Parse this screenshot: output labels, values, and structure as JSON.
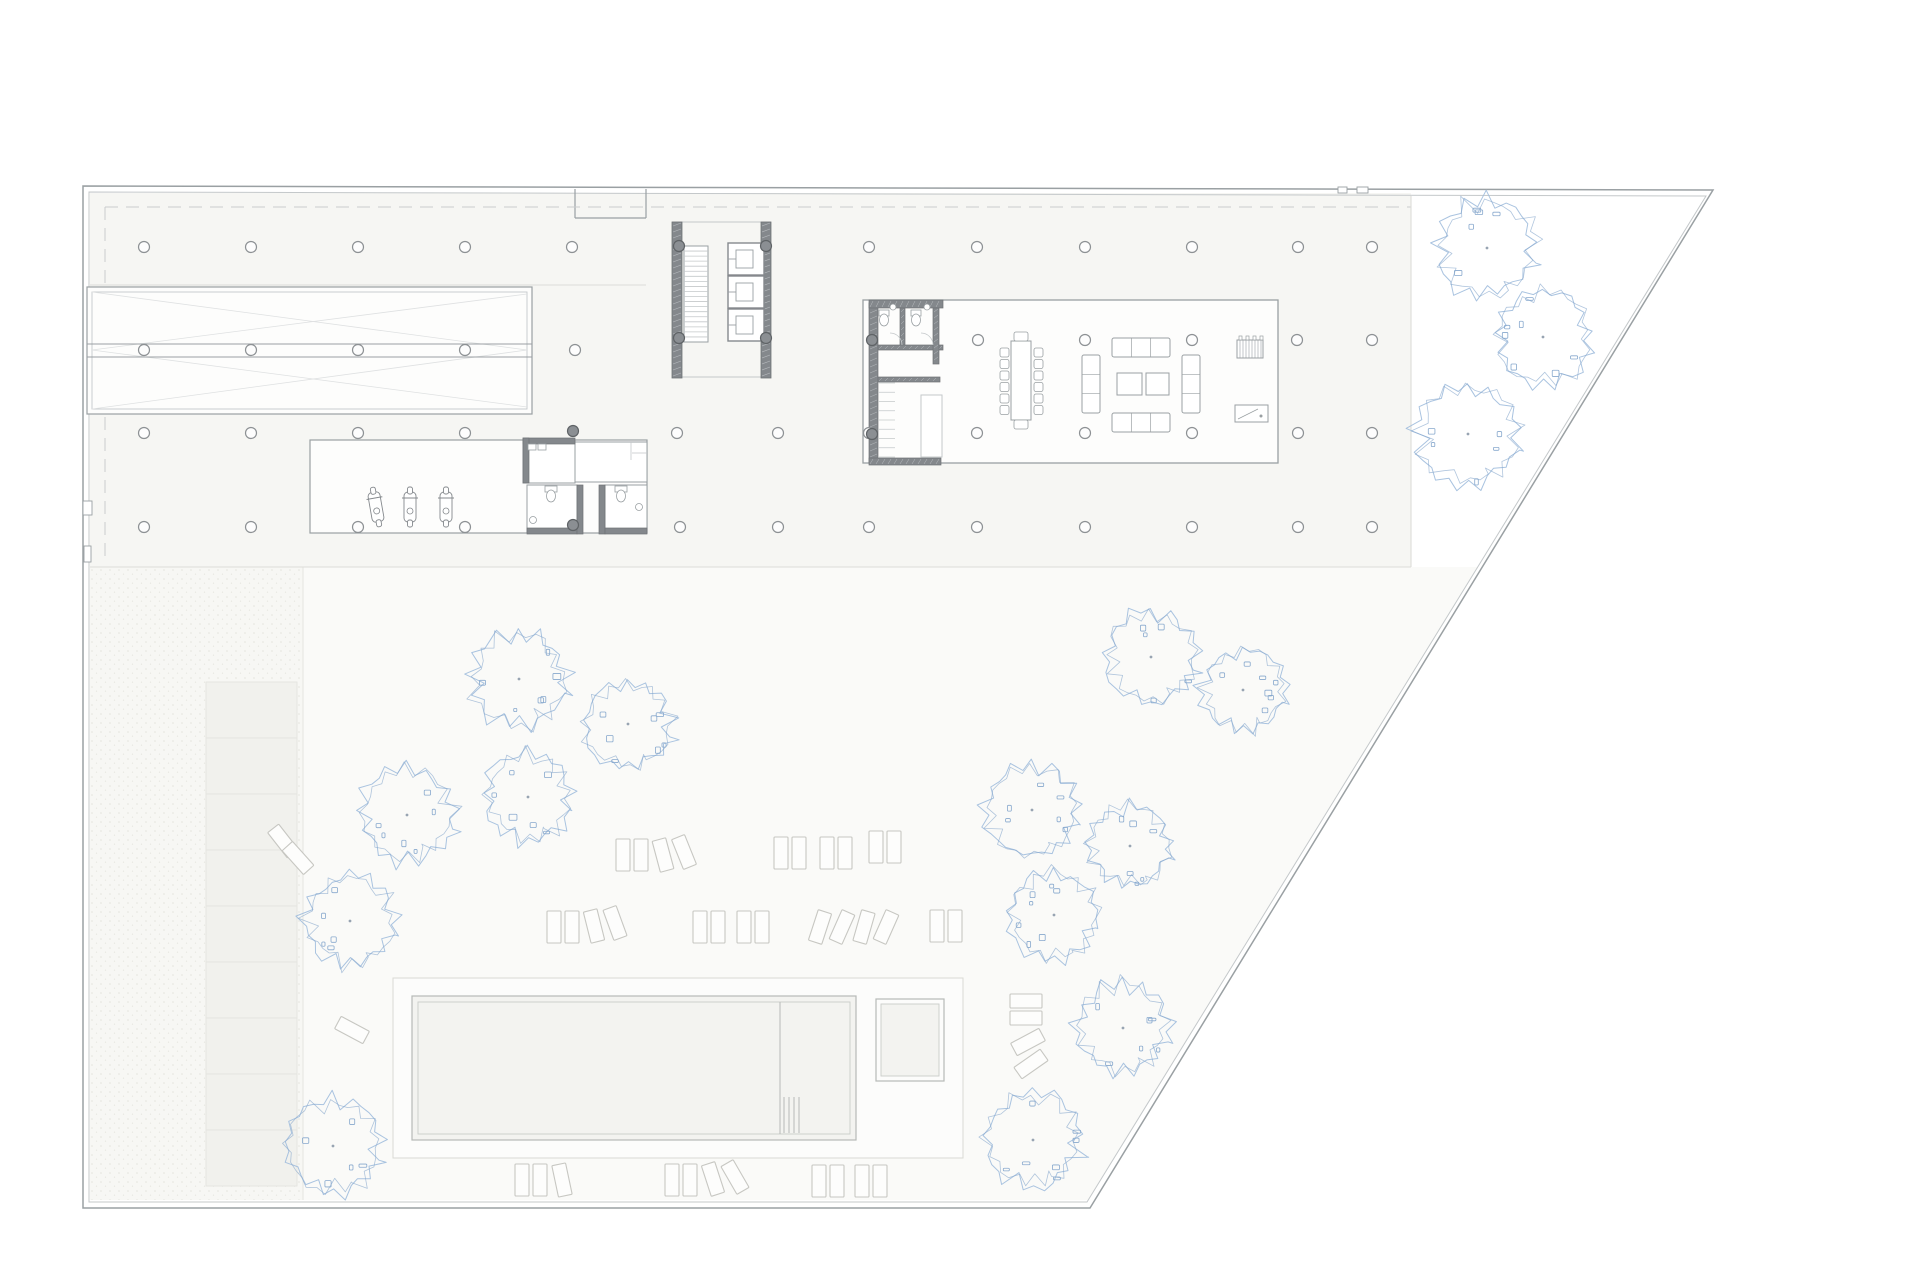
{
  "meta": {
    "title": "architectural-site-plan",
    "description": "Ground floor site plan: trapezoidal plot with building band (parking ramp, stair and elevator core, lounge room, garage, restrooms), pool terrace, loungers and trees"
  },
  "canvas": {
    "w": 1920,
    "h": 1280,
    "bg": "#ffffff"
  },
  "palette": {
    "line": "#9aa0a3",
    "line_light": "#c4c8ca",
    "line_faint": "#dcdcd8",
    "wall_dark": "#84888c",
    "wall_edge": "#6f7376",
    "plate_fill": "#f6f6f3",
    "landscape_fill": "#fafaf8",
    "stipple_fill": "#f7f7f4",
    "parking_fill": "#f1f1ed",
    "parking_line": "#e4e4df",
    "room_fill": "#fdfdfc",
    "pool_fill": "#f3f3f0",
    "deck_fill": "#fcfcfb",
    "deck_line": "#d9d9d5",
    "dash_line": "#c9ccce",
    "tree_stroke": "#a0bddd",
    "tree_accent": "#87a8cd",
    "tree_dot": "#98a4b2",
    "furniture": "#9aa0a3",
    "lounger_line": "#c7c7c2",
    "lounger_fill": "#fdfdfc"
  },
  "site": {
    "outer": [
      [
        83,
        186
      ],
      [
        1713,
        190
      ],
      [
        1090,
        1208
      ],
      [
        83,
        1208
      ]
    ],
    "inner": [
      [
        89,
        192
      ],
      [
        1706,
        196
      ],
      [
        1087,
        1202
      ],
      [
        89,
        1202
      ]
    ],
    "notch": {
      "x1": 575,
      "x2": 646,
      "y_top": 189,
      "y_bottom": 218
    },
    "top_ticks": [
      [
        1338,
        187,
        9,
        6
      ],
      [
        1357,
        187,
        11,
        6
      ]
    ],
    "left_marks": [
      [
        83,
        501,
        9,
        14
      ],
      [
        84,
        546,
        7,
        16
      ]
    ]
  },
  "zones": {
    "plate": {
      "x": 90,
      "y": 193,
      "w": 1321,
      "h": 374
    },
    "landscape": [
      [
        90,
        567
      ],
      [
        1478,
        567
      ],
      [
        1088,
        1200
      ],
      [
        90,
        1200
      ]
    ],
    "stipple": {
      "x": 90,
      "y": 567,
      "w": 213,
      "h": 633
    },
    "divider_x": 303,
    "plate_lines": [
      [
        90,
        285,
        646,
        285
      ],
      [
        90,
        567,
        1411,
        567
      ],
      [
        1411,
        196,
        1411,
        567
      ]
    ]
  },
  "dashed_lines": [
    [
      105,
      207,
      1411,
      207
    ],
    [
      105,
      207,
      105,
      563
    ]
  ],
  "ramp": {
    "outer": {
      "x": 87,
      "y": 287,
      "w": 445,
      "h": 127
    },
    "inset": 5,
    "center_y1": 344,
    "center_y2": 357,
    "diagonals": [
      [
        92,
        292,
        527,
        350
      ],
      [
        92,
        409,
        527,
        350
      ],
      [
        92,
        350,
        527,
        294
      ],
      [
        92,
        350,
        527,
        407
      ]
    ]
  },
  "core": {
    "wall_left": {
      "x": 672,
      "y": 222,
      "w": 10,
      "h": 156
    },
    "wall_right": {
      "x": 761,
      "y": 222,
      "w": 10,
      "h": 156
    },
    "top_line": [
      672,
      222,
      771,
      222
    ],
    "bottom_line": [
      672,
      377,
      771,
      377
    ],
    "stair": {
      "x": 684,
      "y": 246,
      "w": 24,
      "h": 96,
      "treads": 19
    },
    "elevators": {
      "x": 728,
      "w": 36,
      "h": 32,
      "ys": [
        243,
        276,
        309
      ]
    }
  },
  "lounge_room": {
    "rect": {
      "x": 863,
      "y": 300,
      "w": 415,
      "h": 163
    },
    "walls": [
      [
        869,
        303,
        9,
        160
      ],
      [
        869,
        300,
        74,
        8
      ],
      [
        900,
        308,
        5,
        39
      ],
      [
        878,
        345,
        65,
        5
      ],
      [
        933,
        308,
        6,
        56
      ],
      [
        878,
        377,
        62,
        5
      ],
      [
        869,
        458,
        72,
        7
      ]
    ],
    "shaft": {
      "x": 921,
      "y": 395,
      "w": 21,
      "h": 62
    },
    "stair": {
      "x": 878,
      "y": 383,
      "w": 17,
      "h": 74,
      "treads": 9
    },
    "toilets": [
      [
        884,
        318
      ],
      [
        916,
        318
      ]
    ],
    "sinks": [
      [
        893,
        307
      ],
      [
        927,
        307
      ]
    ],
    "door_arcs": [
      [
        902,
        345,
        12
      ],
      [
        933,
        345,
        12
      ]
    ],
    "table": {
      "x": 1011,
      "y": 341,
      "w": 20,
      "h": 79
    },
    "end_chairs": [
      [
        1014,
        332,
        14,
        9
      ],
      [
        1014,
        420,
        14,
        9
      ]
    ],
    "side_chairs": {
      "left_x": 1000,
      "right_x": 1034,
      "y0": 348,
      "step": 11.5,
      "n": 6,
      "size": 9
    },
    "sofas": [
      [
        1112,
        338,
        58,
        19,
        "h"
      ],
      [
        1112,
        413,
        58,
        19,
        "h"
      ],
      [
        1082,
        355,
        18,
        58,
        "v"
      ],
      [
        1182,
        355,
        18,
        58,
        "v"
      ]
    ],
    "coffee_tables": [
      [
        1117,
        373,
        25,
        22
      ],
      [
        1146,
        373,
        23,
        22
      ]
    ],
    "piano": {
      "x": 1237,
      "y": 340,
      "w": 26,
      "h": 18
    },
    "desk": {
      "x": 1235,
      "y": 405,
      "w": 33,
      "h": 17
    }
  },
  "garage": {
    "rect": {
      "x": 310,
      "y": 440,
      "w": 337,
      "h": 93
    },
    "scooters": [
      [
        376,
        507,
        -10
      ],
      [
        410,
        507,
        0
      ],
      [
        446,
        507,
        0
      ]
    ]
  },
  "restrooms": {
    "room_a": {
      "x": 523,
      "y": 440,
      "w": 52,
      "h": 43
    },
    "room_a_walls": [
      [
        523,
        438,
        52,
        6
      ],
      [
        523,
        438,
        6,
        45
      ]
    ],
    "room_b": {
      "x": 575,
      "y": 442,
      "w": 72,
      "h": 40
    },
    "room_b_inner": [
      [
        631,
        442,
        631,
        460
      ],
      [
        632,
        453,
        647,
        453
      ]
    ],
    "cell_c": {
      "x": 527,
      "y": 485,
      "w": 50,
      "h": 48
    },
    "cell_d": {
      "x": 605,
      "y": 485,
      "w": 42,
      "h": 48
    },
    "walls": [
      [
        527,
        528,
        50,
        6
      ],
      [
        577,
        485,
        6,
        49
      ],
      [
        599,
        485,
        6,
        49
      ],
      [
        605,
        528,
        42,
        6
      ]
    ],
    "toilets": [
      [
        551,
        492
      ],
      [
        621,
        492
      ]
    ],
    "sinks_small": [
      [
        533,
        520
      ],
      [
        639,
        507
      ]
    ],
    "sinks_a": [
      [
        528,
        444
      ],
      [
        538,
        444
      ]
    ]
  },
  "columns": {
    "r": 5.5,
    "regular": [
      [
        144,
        247
      ],
      [
        251,
        247
      ],
      [
        358,
        247
      ],
      [
        465,
        247
      ],
      [
        572,
        247
      ],
      [
        869,
        247
      ],
      [
        977,
        247
      ],
      [
        1085,
        247
      ],
      [
        1192,
        247
      ],
      [
        1298,
        247
      ],
      [
        1372,
        247
      ],
      [
        978,
        340
      ],
      [
        1085,
        340
      ],
      [
        1192,
        340
      ],
      [
        1297,
        340
      ],
      [
        1372,
        340
      ],
      [
        144,
        350
      ],
      [
        251,
        350
      ],
      [
        358,
        350
      ],
      [
        465,
        350
      ],
      [
        575,
        350
      ],
      [
        144,
        433
      ],
      [
        251,
        433
      ],
      [
        358,
        433
      ],
      [
        465,
        433
      ],
      [
        677,
        433
      ],
      [
        778,
        433
      ],
      [
        869,
        433
      ],
      [
        977,
        433
      ],
      [
        1085,
        433
      ],
      [
        1192,
        433
      ],
      [
        1298,
        433
      ],
      [
        1372,
        433
      ],
      [
        144,
        527
      ],
      [
        251,
        527
      ],
      [
        358,
        527
      ],
      [
        465,
        527
      ],
      [
        680,
        527
      ],
      [
        778,
        527
      ],
      [
        869,
        527
      ],
      [
        977,
        527
      ],
      [
        1085,
        527
      ],
      [
        1192,
        527
      ],
      [
        1298,
        527
      ],
      [
        1372,
        527
      ]
    ],
    "dark": [
      [
        679,
        246
      ],
      [
        766,
        246
      ],
      [
        679,
        338
      ],
      [
        766,
        338
      ],
      [
        872,
        340
      ],
      [
        872,
        434
      ],
      [
        573,
        431
      ],
      [
        573,
        525
      ]
    ]
  },
  "pool": {
    "deck": {
      "x": 393,
      "y": 978,
      "w": 570,
      "h": 180
    },
    "outer": {
      "x": 412,
      "y": 996,
      "w": 444,
      "h": 144
    },
    "inner": {
      "x": 418,
      "y": 1002,
      "w": 432,
      "h": 132
    },
    "divider_x": 780,
    "ladder_xs": [
      784,
      789,
      794,
      799
    ],
    "ladder_y": [
      1097,
      1133
    ],
    "jacuzzi_outer": {
      "x": 876,
      "y": 999,
      "w": 68,
      "h": 82
    },
    "jacuzzi_inner": {
      "x": 881,
      "y": 1004,
      "w": 58,
      "h": 72
    }
  },
  "parking_strip": {
    "x": 206,
    "y": 682,
    "w": 91,
    "rows": 9,
    "row_h": 56
  },
  "loungers": {
    "w": 14,
    "h": 32,
    "items": [
      [
        623,
        855,
        0
      ],
      [
        641,
        855,
        0
      ],
      [
        663,
        855,
        -15
      ],
      [
        684,
        852,
        -22
      ],
      [
        781,
        853,
        0
      ],
      [
        799,
        853,
        0
      ],
      [
        827,
        853,
        0
      ],
      [
        845,
        853,
        0
      ],
      [
        876,
        847,
        0
      ],
      [
        894,
        847,
        0
      ],
      [
        554,
        927,
        0
      ],
      [
        572,
        927,
        0
      ],
      [
        594,
        926,
        -14
      ],
      [
        615,
        923,
        -20
      ],
      [
        700,
        927,
        0
      ],
      [
        718,
        927,
        0
      ],
      [
        744,
        927,
        0
      ],
      [
        762,
        927,
        0
      ],
      [
        820,
        927,
        18
      ],
      [
        842,
        927,
        24
      ],
      [
        864,
        927,
        16
      ],
      [
        886,
        927,
        24
      ],
      [
        937,
        926,
        0
      ],
      [
        955,
        926,
        0
      ],
      [
        283,
        841,
        -38
      ],
      [
        298,
        858,
        -42
      ],
      [
        352,
        1030,
        -62
      ],
      [
        1026,
        1001,
        90
      ],
      [
        1026,
        1018,
        90
      ],
      [
        1028,
        1042,
        62
      ],
      [
        1031,
        1064,
        55
      ],
      [
        522,
        1180,
        0
      ],
      [
        540,
        1180,
        0
      ],
      [
        562,
        1180,
        -12
      ],
      [
        672,
        1180,
        0
      ],
      [
        690,
        1180,
        0
      ],
      [
        713,
        1179,
        -18
      ],
      [
        735,
        1177,
        -30
      ],
      [
        819,
        1181,
        0
      ],
      [
        837,
        1181,
        0
      ],
      [
        862,
        1181,
        0
      ],
      [
        880,
        1181,
        0
      ]
    ]
  },
  "trees": [
    [
      1487,
      248,
      57
    ],
    [
      1543,
      337,
      54
    ],
    [
      1468,
      434,
      57
    ],
    [
      1151,
      657,
      52
    ],
    [
      1243,
      690,
      47
    ],
    [
      1032,
      810,
      52
    ],
    [
      1130,
      846,
      46
    ],
    [
      1054,
      915,
      50
    ],
    [
      1123,
      1028,
      52
    ],
    [
      1033,
      1140,
      54
    ],
    [
      519,
      679,
      54
    ],
    [
      628,
      724,
      50
    ],
    [
      407,
      815,
      54
    ],
    [
      528,
      797,
      50
    ],
    [
      350,
      921,
      51
    ],
    [
      333,
      1146,
      53
    ]
  ]
}
